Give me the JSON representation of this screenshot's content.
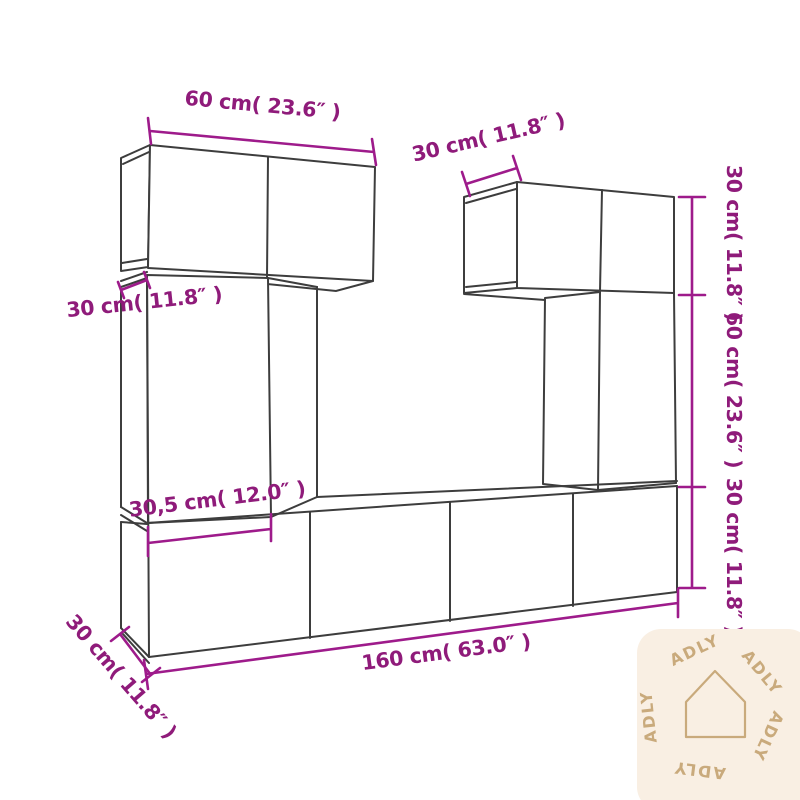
{
  "colors": {
    "background": "#ffffff",
    "line": "#3d3d3d",
    "dimension": "#8f1b7a",
    "dimension_line": "#9e1b8b",
    "watermark_bg": "#f9efe3",
    "watermark_glyph": "#c9aa7c"
  },
  "diagram": {
    "description": "Wall-mounted TV cabinet set dimension diagram",
    "dimensions": {
      "top_cabinet_width": "60 cm( 23.6″ )",
      "right_cabinet_depth": "30 cm( 11.8″ )",
      "right_top_height": "30 cm( 11.8″ )",
      "right_middle_height": "60 cm( 23.6″ )",
      "right_bottom_height": "30 cm( 11.8″ )",
      "left_cabinet_depth": "30 cm( 11.8″ )",
      "left_cabinet_width": "30,5 cm( 12.0″ )",
      "bench_width": "160 cm( 63.0″ )",
      "bench_depth": "30 cm( 11.8″ )"
    }
  },
  "watermark": {
    "brand": "ADLY",
    "icon": "house-outline",
    "words": [
      "ADLY",
      "ADLY",
      "ADLY",
      "ADLY",
      "ADLY"
    ]
  }
}
